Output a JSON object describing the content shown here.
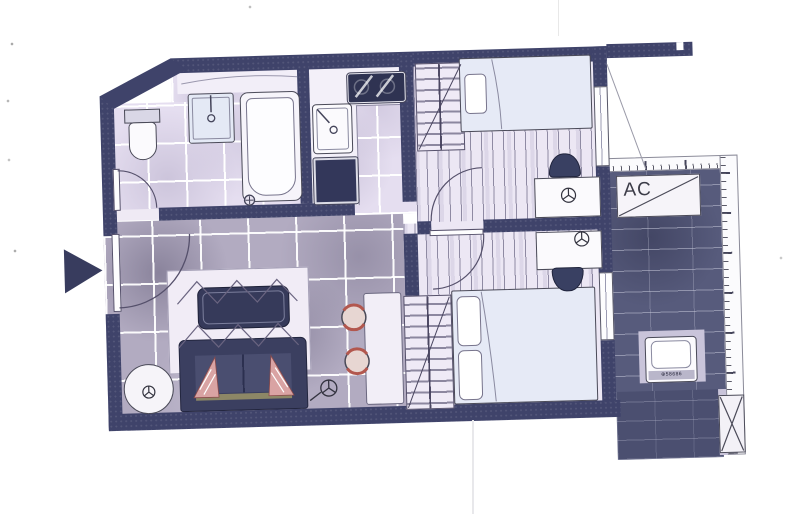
{
  "document": {
    "kind": "scanned apartment floor plan",
    "page_color": "#ffffff"
  },
  "labels": {
    "ac_unit": "AC",
    "washer_panel": "⊕58686"
  },
  "colors": {
    "wall": "#3f436a",
    "bath_tile": "#e5def0",
    "living_tile": "#b2abc1",
    "wood_floor": "#ece7f4",
    "balcony_brick": "#575b7c",
    "balcony_brick_dark": "#4b4f70",
    "dark_furniture": "#3a3e5e",
    "bed_linen": "#e6eaf6",
    "cushion_pink": "#d9a3a3",
    "stool_red": "#b2574e",
    "sofa_rail_tan": "#8d8766"
  },
  "regions": [
    "bathroom",
    "kitchen",
    "hallway",
    "living-dining",
    "bedroom-1",
    "bedroom-2",
    "balcony"
  ],
  "icons": {
    "entrance_marker": "solid right-pointing triangle",
    "ceiling_light": "circle with three radial spokes",
    "door_swing": "quarter-circle arc",
    "wardrobe": "hatched rectangle with diagonal",
    "ac_unit": "rectangle with diagonal line",
    "planter_box": "rectangle with X cross",
    "ruler_strip": "tick-marked measuring strip"
  }
}
